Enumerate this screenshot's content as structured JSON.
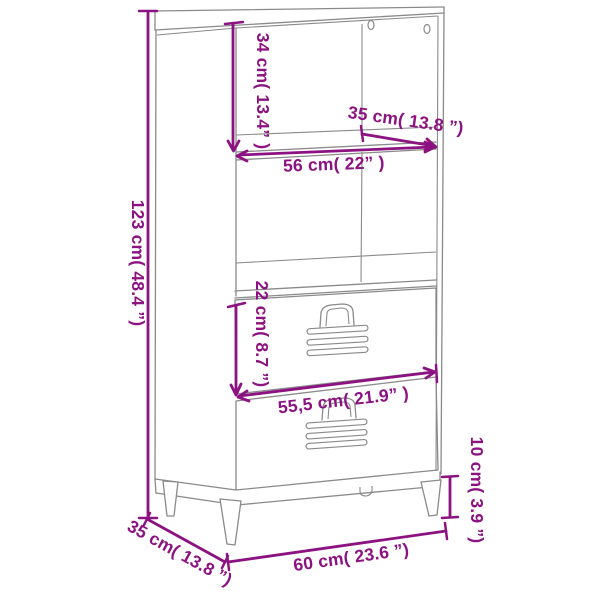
{
  "colors": {
    "annotation": "#8D1281",
    "structure": "#8A8A8A",
    "background": "#FFFFFF"
  },
  "measurements": {
    "overall_height": {
      "value_cm": "123",
      "value_in": "48.4",
      "label": "123 cm( 48.4  ”)"
    },
    "top_compartment_height": {
      "value_cm": "34",
      "value_in": "13.4",
      "label": "34 cm( 13.4”  )"
    },
    "top_depth": {
      "value_cm": "35",
      "value_in": "13.8",
      "label": "35 cm( 13.8  ”)"
    },
    "inner_width": {
      "value_cm": "56",
      "value_in": "22",
      "label": "56 cm( 22”  )"
    },
    "drawer_front_height": {
      "value_cm": "22",
      "value_in": "8.7",
      "label": "22 cm( 8.7  ”)"
    },
    "drawer_front_width": {
      "value_cm": "55,5",
      "value_in": "21.9",
      "label": "55,5 cm( 21.9”  )"
    },
    "leg_height": {
      "value_cm": "10",
      "value_in": "3.9",
      "label": "10 cm( 3.9  ”)"
    },
    "overall_width": {
      "value_cm": "60",
      "value_in": "23.6",
      "label": "60 cm( 23.6  ”)"
    },
    "overall_depth": {
      "value_cm": "35",
      "value_in": "13.8",
      "label": "35 cm( 13.8  ”)"
    }
  }
}
